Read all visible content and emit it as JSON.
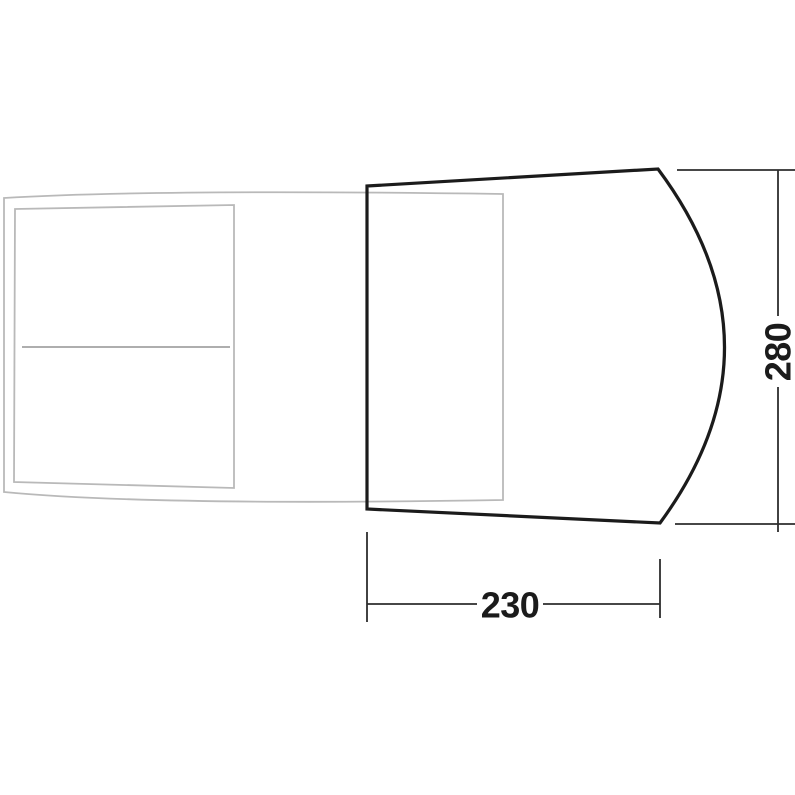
{
  "dimensions": {
    "width": "230",
    "depth": "280"
  },
  "colors": {
    "background": "#ffffff",
    "awning_outline": "#1b1b1b",
    "vehicle_outline": "#b9b9b9",
    "vehicle_divider": "#a2a2a2",
    "dimension_line": "#2d2d2d",
    "dimension_text": "#1b1b1b"
  }
}
